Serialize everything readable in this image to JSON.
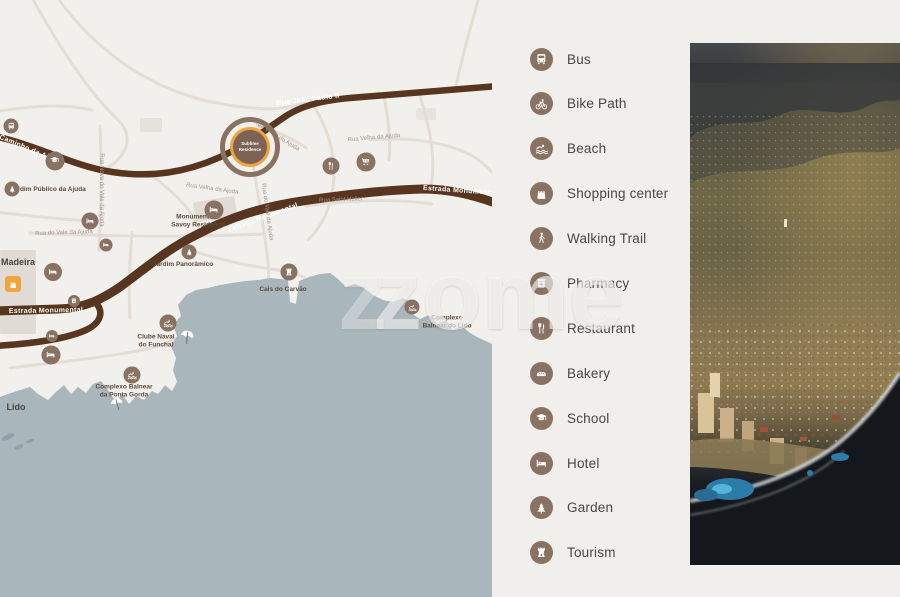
{
  "theme": {
    "background": "#f0efec",
    "map_land": "#f2f0ed",
    "water": "#a9b7bd",
    "road_primary": "#57351e",
    "road_secondary": "#e4ddd5",
    "poi_circle": "#8a7263",
    "accent_orange": "#f0a43c",
    "legend_text": "#474747",
    "street_label": "#a3968a",
    "poi_label": "#5d4a3c"
  },
  "watermark": {
    "ghost": "z",
    "text": "zome"
  },
  "legend": {
    "items": [
      {
        "id": "bus",
        "label": "Bus",
        "icon": "bus-icon",
        "sym": "sym-bus"
      },
      {
        "id": "bike-path",
        "label": "Bike Path",
        "icon": "bike-icon",
        "sym": "sym-bike"
      },
      {
        "id": "beach",
        "label": "Beach",
        "icon": "swimmer-icon",
        "sym": "sym-swim"
      },
      {
        "id": "shopping-center",
        "label": "Shopping center",
        "icon": "shopping-bag-icon",
        "sym": "sym-bag"
      },
      {
        "id": "walking-trail",
        "label": "Walking Trail",
        "icon": "pedestrian-icon",
        "sym": "sym-walk"
      },
      {
        "id": "pharmacy",
        "label": "Pharmacy",
        "icon": "pharmacy-icon",
        "sym": "sym-pharmacy"
      },
      {
        "id": "restaurant",
        "label": "Restaurant",
        "icon": "fork-knife-icon",
        "sym": "sym-restaurant"
      },
      {
        "id": "bakery",
        "label": "Bakery",
        "icon": "bread-icon",
        "sym": "sym-bakery"
      },
      {
        "id": "school",
        "label": "School",
        "icon": "graduation-cap-icon",
        "sym": "sym-school"
      },
      {
        "id": "hotel",
        "label": "Hotel",
        "icon": "bed-icon",
        "sym": "sym-hotel"
      },
      {
        "id": "garden",
        "label": "Garden",
        "icon": "pine-tree-icon",
        "sym": "sym-garden"
      },
      {
        "id": "tourism",
        "label": "Tourism",
        "icon": "castle-tower-icon",
        "sym": "sym-tourism"
      }
    ]
  },
  "map": {
    "marker": {
      "x": 250,
      "y": 147,
      "line1": "Sublime",
      "line2": "Residence"
    },
    "labels": [
      {
        "kind": "road",
        "text": "Rua João Paulo II",
        "x": 308,
        "y": 100,
        "rot": -7
      },
      {
        "kind": "road",
        "text": "Caminho da Ajuda",
        "x": 30,
        "y": 150,
        "rot": 23
      },
      {
        "kind": "road",
        "text": "Estrada Monumental",
        "x": 46,
        "y": 311,
        "rot": -1
      },
      {
        "kind": "road",
        "text": "Estrada Monumental",
        "x": 263,
        "y": 218,
        "rot": -20
      },
      {
        "kind": "road",
        "text": "Estrada Monumental",
        "x": 460,
        "y": 191,
        "rot": 4
      },
      {
        "kind": "street",
        "text": "Rua Velha da Ajuda",
        "x": 276,
        "y": 137,
        "rot": 32
      },
      {
        "kind": "street",
        "text": "Rua Velha da Ajuda",
        "x": 374,
        "y": 139,
        "rot": -5
      },
      {
        "kind": "street",
        "text": "Rua Velha da Ajuda",
        "x": 212,
        "y": 190,
        "rot": 8
      },
      {
        "kind": "street",
        "text": "Rua Saint Helier",
        "x": 341,
        "y": 201,
        "rot": -2
      },
      {
        "kind": "street",
        "text": "Rua do Vale da Ajuda",
        "x": 64,
        "y": 234,
        "rot": -2
      },
      {
        "kind": "street",
        "text": "Rua Nova do Vale da Ajuda",
        "x": 100,
        "y": 190,
        "rot": 90
      },
      {
        "kind": "street",
        "text": "Rua do Vale da Ajuda",
        "x": 266,
        "y": 212,
        "rot": 82
      },
      {
        "kind": "poi",
        "lines": [
          "Jardim Público da Ajuda"
        ],
        "x": 48,
        "y": 190
      },
      {
        "kind": "poi",
        "lines": [
          "Monumentalis",
          "Savoy Residence"
        ],
        "x": 198,
        "y": 222
      },
      {
        "kind": "poi",
        "lines": [
          "Jardim Panorâmico"
        ],
        "x": 183,
        "y": 265
      },
      {
        "kind": "poi",
        "lines": [
          "Clube Naval",
          "do Funchal"
        ],
        "x": 156,
        "y": 342
      },
      {
        "kind": "poi",
        "lines": [
          "Complexo Balnear",
          "da Ponta Gorda"
        ],
        "x": 124,
        "y": 392
      },
      {
        "kind": "poi",
        "lines": [
          "Cais do Carvão"
        ],
        "x": 283,
        "y": 290
      },
      {
        "kind": "poi",
        "lines": [
          "Complexo",
          "Balnear do Lido"
        ],
        "x": 447,
        "y": 323
      },
      {
        "kind": "place",
        "lines": [
          "Madeira"
        ],
        "x": 18,
        "y": 263
      },
      {
        "kind": "place",
        "lines": [
          "Lido"
        ],
        "x": 16,
        "y": 408
      }
    ],
    "icons": [
      {
        "name": "bus-icon",
        "sym": "sym-bus",
        "x": 11,
        "y": 126,
        "d": 15
      },
      {
        "name": "school-icon",
        "sym": "sym-school",
        "x": 55,
        "y": 161,
        "d": 19
      },
      {
        "name": "garden-icon",
        "sym": "sym-garden",
        "x": 12,
        "y": 189,
        "d": 15
      },
      {
        "name": "hotel-icon",
        "sym": "sym-hotel",
        "x": 90,
        "y": 221,
        "d": 17
      },
      {
        "name": "hotel-icon",
        "sym": "sym-hotel",
        "x": 106,
        "y": 245,
        "d": 13
      },
      {
        "name": "hotel-icon",
        "sym": "sym-hotel",
        "x": 53,
        "y": 272,
        "d": 18
      },
      {
        "name": "pharmacy-icon",
        "sym": "sym-pharmacy",
        "x": 74,
        "y": 301,
        "d": 12
      },
      {
        "name": "hotel-icon",
        "sym": "sym-hotel",
        "x": 52,
        "y": 336,
        "d": 12
      },
      {
        "name": "hotel-icon",
        "sym": "sym-hotel",
        "x": 51,
        "y": 355,
        "d": 19
      },
      {
        "name": "hotel-icon",
        "sym": "sym-hotel",
        "x": 214,
        "y": 210,
        "d": 19
      },
      {
        "name": "restaurant-icon",
        "sym": "sym-restaurant",
        "x": 331,
        "y": 166,
        "d": 17
      },
      {
        "name": "cart-icon",
        "sym": "sym-cart",
        "x": 366,
        "y": 162,
        "d": 19
      },
      {
        "name": "garden-icon",
        "sym": "sym-garden",
        "x": 189,
        "y": 252,
        "d": 15
      },
      {
        "name": "tourism-icon",
        "sym": "sym-tourism",
        "x": 289,
        "y": 272,
        "d": 17
      },
      {
        "name": "swim-icon",
        "sym": "sym-swim",
        "x": 168,
        "y": 323,
        "d": 17
      },
      {
        "name": "swim-icon",
        "sym": "sym-swim",
        "x": 132,
        "y": 375,
        "d": 17
      },
      {
        "name": "swim-icon",
        "sym": "sym-swim",
        "x": 412,
        "y": 307,
        "d": 15
      },
      {
        "name": "shopping-icon",
        "sym": "sym-bag",
        "x": 13,
        "y": 284,
        "d": 16,
        "variant": "square-accent"
      },
      {
        "name": "beach-umbrella-icon",
        "sym": "sym-umbrella",
        "x": 117,
        "y": 404,
        "d": 17,
        "variant": "plain",
        "rot": -12
      },
      {
        "name": "beach-umbrella-icon",
        "sym": "sym-umbrella",
        "x": 187,
        "y": 337,
        "d": 19,
        "variant": "plain",
        "rot": 10
      }
    ]
  }
}
